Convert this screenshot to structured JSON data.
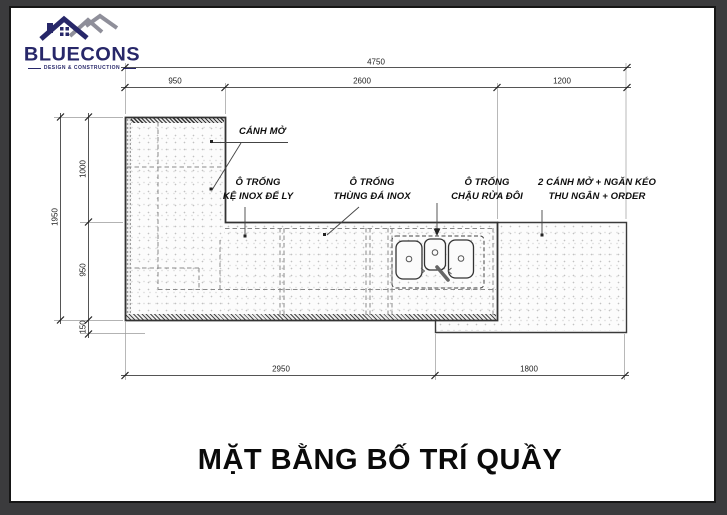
{
  "logo": {
    "name": "BLUECONS",
    "tagline": "DESIGN & CONSTRUCTION"
  },
  "drawing": {
    "title": "MẶT BẰNG BỐ TRÍ QUẦY",
    "annotations": {
      "door_open": "CÁNH MỞ",
      "slot_shelf": [
        "Ô TRỐNG",
        "KỆ INOX ĐỂ LY"
      ],
      "slot_icebin": [
        "Ô TRỐNG",
        "THÙNG ĐÁ INOX"
      ],
      "slot_sink": [
        "Ô TRỐNG",
        "CHẬU RỬA ĐÔI"
      ],
      "cashier": [
        "2 CÁNH MỞ + NGĂN KÉO",
        "THU NGÂN + ORDER"
      ]
    },
    "dimensions": {
      "top_overall": "4750",
      "top_segments": [
        "950",
        "2600",
        "1200"
      ],
      "left_overall": "1950",
      "left_segments": [
        "1000",
        "950",
        "150"
      ],
      "bottom_segments": [
        "2950",
        "1800"
      ]
    }
  },
  "colors": {
    "logo_navy": "#272769",
    "logo_gray": "#8f8f9a",
    "ink": "#2d2d2d",
    "frame": "#3b3b3d"
  }
}
